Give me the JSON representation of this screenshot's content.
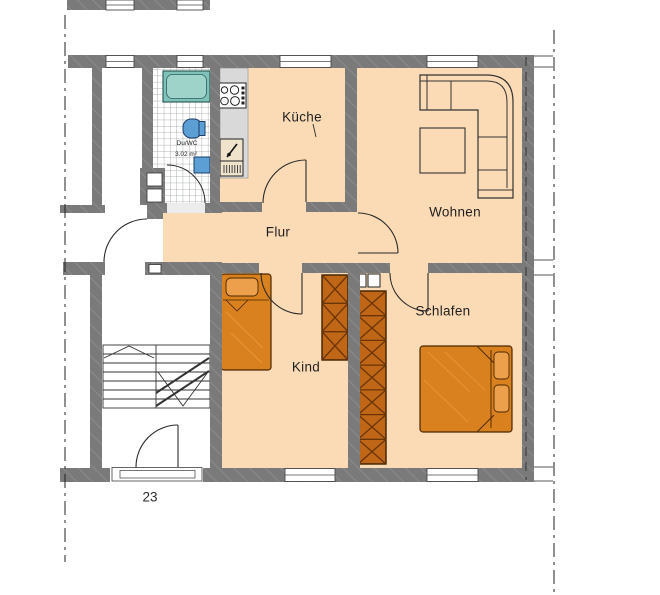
{
  "drawing_type": "apartment-floor-plan",
  "rooms": {
    "kueche": "Küche",
    "wohnen": "Wohnen",
    "flur": "Flur",
    "kind": "Kind",
    "schlafen": "Schlafen"
  },
  "bathroom": {
    "name": "Du/WC",
    "area": "3.02 m²"
  },
  "house_number": "23",
  "colors": {
    "wall": "#7a7a7a",
    "floor": "#fbdbb6",
    "furniture_wood": "#d9811f",
    "wardrobe": "#bf6717",
    "bathtub": "#7fc2ba",
    "sanitary_blue": "#5b9fd4",
    "counter": "#d9d9d9"
  },
  "fixtures": [
    "bathtub",
    "toilet",
    "wash-basin",
    "stove",
    "kitchen-sink",
    "corner-sofa",
    "coffee-table",
    "single-bed",
    "double-bed",
    "wardrobe-kind",
    "wardrobe-schlafen",
    "staircase",
    "entrance-doors",
    "windows"
  ]
}
